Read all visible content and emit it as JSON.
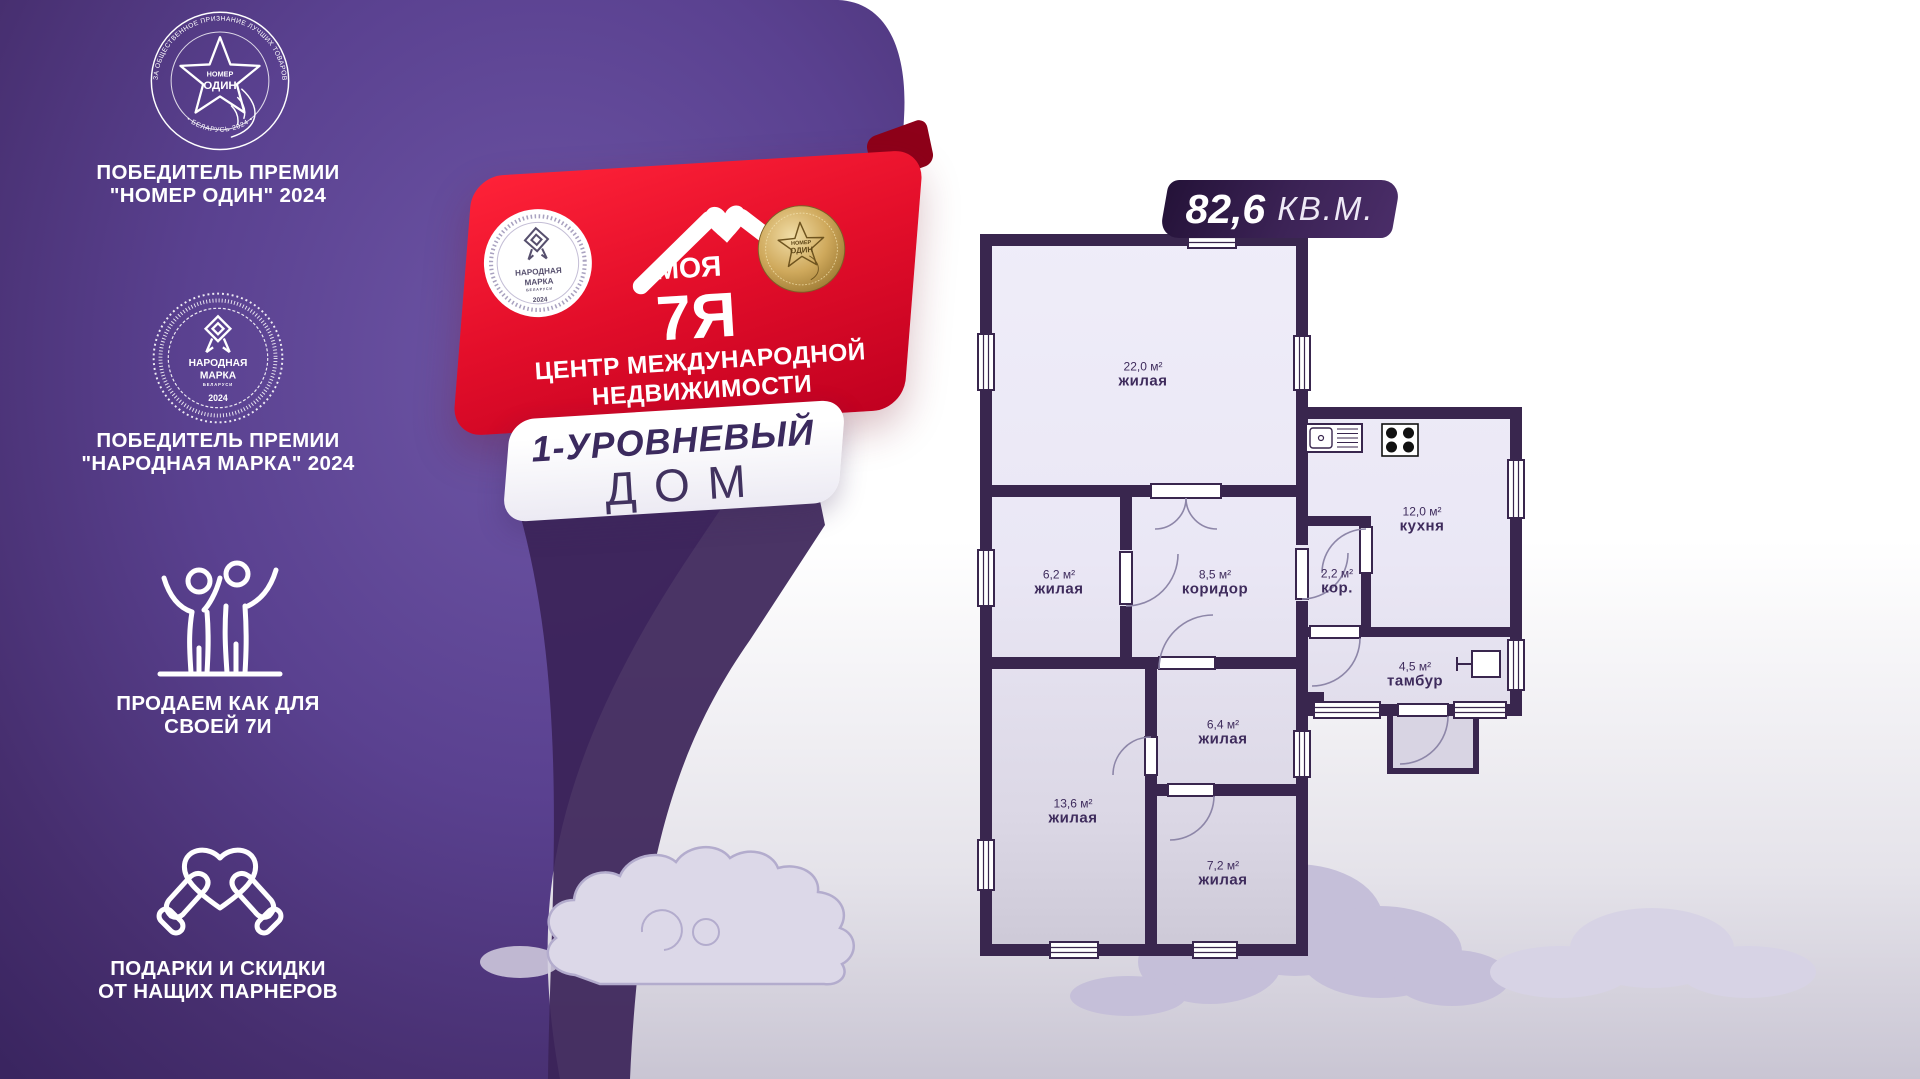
{
  "colors": {
    "purple_dark": "#3a2560",
    "purple_light": "#6e56a6",
    "red": "#e30e2a",
    "red_dark": "#8e0019",
    "wall": "#39264e",
    "accent_text": "#3b2a5e",
    "gold": "#cfa95c"
  },
  "left_panel": {
    "award1": {
      "emblem_line1": "НОМЕР",
      "emblem_line2": "ОДИН",
      "ring_top": "ПРЕМИЯ ЗА ОБЩЕСТВЕННОЕ ПРИЗНАНИЕ ЛУЧШИХ ТОВАРОВ И УСЛУГ",
      "ring_bottom": "• БЕЛАРУСЬ 2024 •",
      "caption1": "ПОБЕДИТЕЛЬ ПРЕМИИ",
      "caption2": "\"НОМЕР ОДИН\" 2024"
    },
    "award2": {
      "emblem_line1": "НАРОДНАЯ",
      "emblem_line2": "МАРКА",
      "emblem_line3": "БЕЛАРУСИ",
      "emblem_year": "2024",
      "caption1": "ПОБЕДИТЕЛЬ ПРЕМИИ",
      "caption2": "\"НАРОДНАЯ МАРКА\" 2024"
    },
    "feature1": {
      "caption1": "ПРОДАЕМ КАК ДЛЯ",
      "caption2": "СВОЕЙ 7И"
    },
    "feature2": {
      "caption1": "ПОДАРКИ И СКИДКИ",
      "caption2": "ОТ НАЩИХ ПАРНЕРОВ"
    }
  },
  "ribbon": {
    "seal": {
      "line1": "НАРОДНАЯ",
      "line2": "МАРКА",
      "line3": "БЕЛАРУСИ",
      "year": "2024"
    },
    "brand": {
      "word": "МОЯ",
      "mark": "7Я"
    },
    "medal": {
      "line1": "НОМЕР",
      "line2": "ОДИН"
    },
    "subtitle1": "ЦЕНТР МЕЖДУНАРОДНОЙ",
    "subtitle2": "НЕДВИЖИМОСТИ"
  },
  "banner": {
    "line1": "1-УРОВНЕВЫЙ",
    "line2": "ДОМ"
  },
  "floorplan": {
    "total_area": "82,6",
    "total_unit": "КВ.М.",
    "rooms": [
      {
        "id": "living-22",
        "area": "22,0 м²",
        "name": "жилая"
      },
      {
        "id": "living-62",
        "area": "6,2 м²",
        "name": "жилая"
      },
      {
        "id": "corridor-85",
        "area": "8,5 м²",
        "name": "коридор"
      },
      {
        "id": "corridor-22",
        "area": "2,2 м²",
        "name": "кор."
      },
      {
        "id": "kitchen",
        "area": "12,0 м²",
        "name": "кухня"
      },
      {
        "id": "tambour",
        "area": "4,5 м²",
        "name": "тамбур"
      },
      {
        "id": "living-64",
        "area": "6,4 м²",
        "name": "жилая"
      },
      {
        "id": "living-136",
        "area": "13,6 м²",
        "name": "жилая"
      },
      {
        "id": "living-72",
        "area": "7,2 м²",
        "name": "жилая"
      }
    ]
  }
}
